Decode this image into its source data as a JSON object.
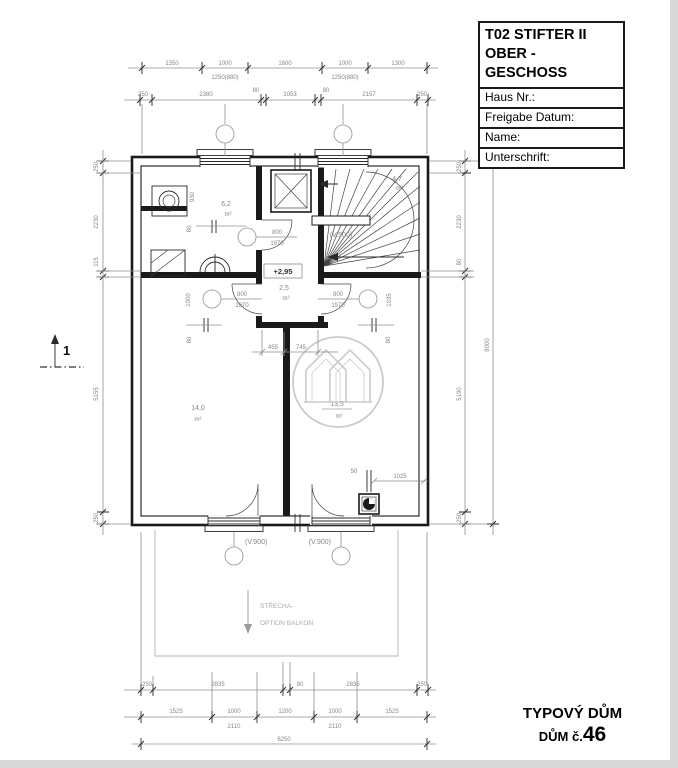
{
  "title_block": {
    "line1": "T02 STIFTER II",
    "line2": "OBER - GESCHOSS",
    "fields": [
      "Haus Nr.:",
      "Freigabe Datum:",
      "Name:",
      "Unterschrift:"
    ]
  },
  "footer": {
    "line1": "TYPOVÝ DŮM",
    "line2_prefix": "DŮM č.",
    "line2_number": "46"
  },
  "section_marker": {
    "label": "1"
  },
  "rooms": {
    "bathroom": {
      "area": "6,2",
      "unit": "m²"
    },
    "stairs": {
      "area": "4,7",
      "unit": "m²"
    },
    "hall": {
      "area": "2,5",
      "unit": "m²"
    },
    "room_left": {
      "area": "14,0",
      "unit": "m²"
    },
    "room_right": {
      "area": "13,5",
      "unit": "m²"
    }
  },
  "doors": {
    "bath": {
      "width": "800",
      "height": "1970"
    },
    "left": {
      "width": "800",
      "height": "1970"
    },
    "right": {
      "width": "800",
      "height": "1970"
    }
  },
  "labels": {
    "level": "+2,95",
    "stair_parapet": "(V.900)",
    "window_left": "(V.900)",
    "window_right": "(V.900)",
    "roof_line1": "STŘECHA-",
    "roof_line2": "OPTION BALKON"
  },
  "dims": {
    "top1": [
      "1350",
      "1000",
      "1600",
      "1000",
      "1300"
    ],
    "top1_sub": [
      "1250(880)",
      "1250(880)"
    ],
    "top2": [
      "250",
      "2380",
      "80",
      "1053",
      "80",
      "2157",
      "250"
    ],
    "bottom1": [
      "250",
      "2835",
      "80",
      "2835",
      "250"
    ],
    "bottom2": [
      "1525",
      "1000",
      "1200",
      "1000",
      "1525"
    ],
    "bottom2_sub": [
      "2110",
      "2110"
    ],
    "bottom_total": "6250",
    "left": [
      "250",
      "2230",
      "115",
      "5155",
      "250"
    ],
    "right": [
      "250",
      "2230",
      "80",
      "5190",
      "250"
    ],
    "right_total": "8000",
    "hall": [
      "455",
      "745"
    ],
    "bath": [
      "930",
      "80"
    ],
    "room_left": [
      "1000",
      "80"
    ],
    "room_right": [
      "1035",
      "80"
    ],
    "chimney": [
      "50",
      "1025"
    ]
  }
}
